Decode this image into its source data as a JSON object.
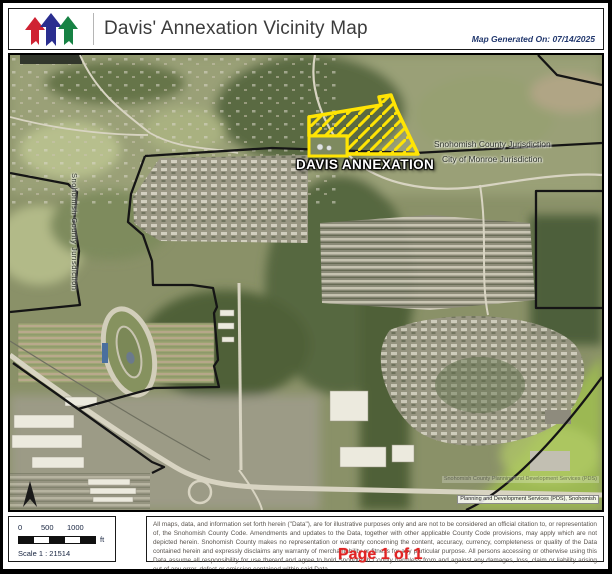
{
  "header": {
    "title": "Davis' Annexation Vicinity Map",
    "generated": "Map Generated On: 07/14/2025",
    "logo_colors": {
      "red": "#cf2233",
      "blue": "#2a2e8f",
      "green": "#178244"
    }
  },
  "map": {
    "annexation_label": "DAVIS ANNEXATION",
    "county_jurisdiction_label": "Snohomish County Jurisdiction",
    "city_jurisdiction_label": "City of Monroe Jurisdiction",
    "west_jurisdiction_label": "Snohomish County Jurisdiction",
    "attribution_line1": "Snohomish County Planning and Development Services (PDS)",
    "attribution_line2": "Planning and Development Services (PDS), Snohomish",
    "annexation_color": "#ffe404",
    "boundary_color": "#151515"
  },
  "scale": {
    "ticks": [
      "0",
      "500",
      "1000"
    ],
    "unit": "ft",
    "ratio": "Scale 1 : 21514"
  },
  "footer": {
    "disclaimer": "All maps, data, and information set forth herein (\"Data\"), are for illustrative purposes only and are not to be considered an official citation to, or representation of, the Snohomish County Code. Amendments and updates to the Data, together with other applicable County Code provisions, may apply which are not depicted herein. Snohomish County makes no representation or warranty concerning the content, accuracy, currency, completeness or quality of the Data contained herein and expressly disclaims any warranty of merchantability or fitness for any particular purpose. All persons accessing or otherwise using this Data assume all responsibility for use thereof and agree to hold Snohomish County harmless from and against any damages, loss, claim or liability arising out of any error, defect or omission contained within said Data.",
    "page_number": "Page 1 of 1",
    "page_number_color": "#e02424"
  }
}
